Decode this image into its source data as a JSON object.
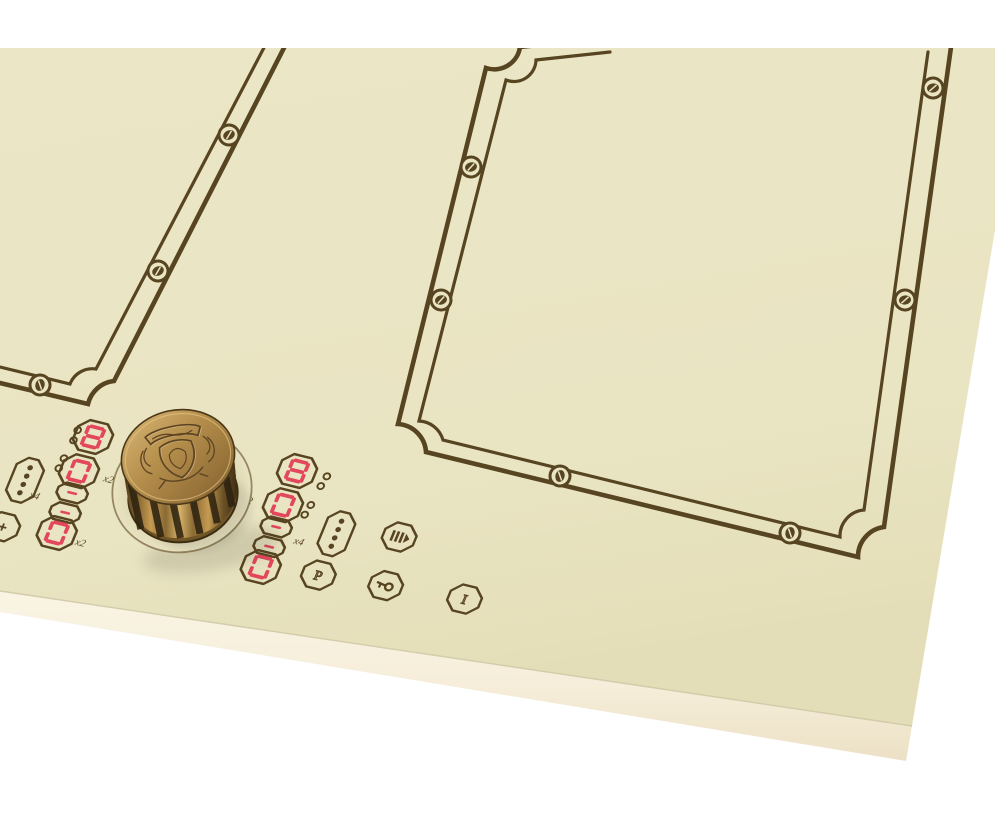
{
  "scene": {
    "background": "#ffffff"
  },
  "panel": {
    "surface_color": "#e9e4c2",
    "surface_color_dark": "#e5dfba",
    "engraving_color": "#574420",
    "edge_strip_color": "#f8f1e0",
    "edge_strip_color_dark": "#efe5ca"
  },
  "knob": {
    "ring_label": "− PARAMETER +",
    "emblem": "heraldic-crest-emblem",
    "bronze_light": "#d8b269",
    "bronze_dark": "#4a3718"
  },
  "displays": {
    "led_color": "#e2475c",
    "left": {
      "digits": [
        "8",
        "0",
        "-",
        "-",
        "0"
      ],
      "labels": {
        "top": "x2",
        "mid": "x4",
        "bottom": "x2"
      }
    },
    "right": {
      "digits": [
        "8",
        "0",
        "-",
        "-",
        "0"
      ],
      "labels": {
        "top": "x2",
        "mid": "x4"
      }
    }
  },
  "badges": {
    "plus_label": "+",
    "pause_label": "P",
    "info_label": "I"
  },
  "icons": {
    "left_dots": "power-level-dots-icon",
    "right_dots": "power-level-dots-icon",
    "plus": "plus-icon",
    "boost": "boost-icon",
    "pause": "pause-p-icon",
    "key": "key-lock-icon",
    "info": "info-icon",
    "screws": "slotted-screw-icon"
  }
}
